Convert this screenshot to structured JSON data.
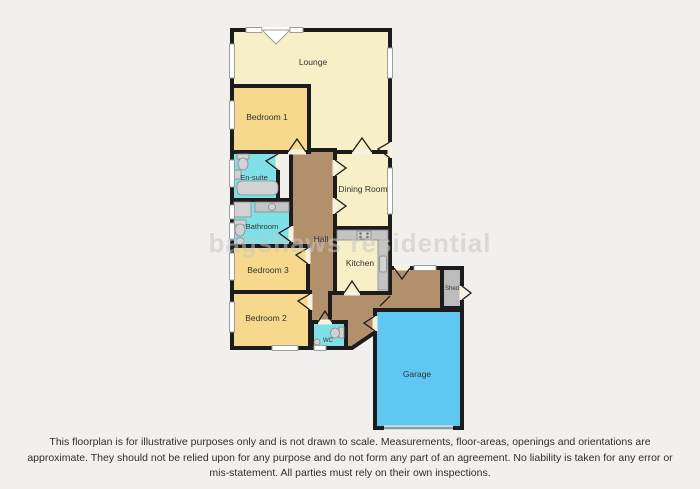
{
  "watermark": "bagshaws residential",
  "disclaimer": "This floorplan is for illustrative purposes only and is not drawn to scale. Measurements, floor-areas, openings and orientations are approximate. They should not be relied upon for any purpose and do not form any part of an agreement. No liability is taken for any error or mis-statement. All parties must rely on their own inspections.",
  "rooms": [
    {
      "label": "Lounge"
    },
    {
      "label": "Bedroom 1"
    },
    {
      "label": "En-suite"
    },
    {
      "label": "Bathroom"
    },
    {
      "label": "Dining Room"
    },
    {
      "label": "Hall"
    },
    {
      "label": "Kitchen"
    },
    {
      "label": "Bedroom 3"
    },
    {
      "label": "Bedroom 2"
    },
    {
      "label": "WC"
    },
    {
      "label": "Shed"
    },
    {
      "label": "Garage"
    }
  ],
  "colors": {
    "background": "#F1F0EE",
    "wall": "#1C1C1C",
    "living": "#F6EFC7",
    "bedroom": "#F6D98C",
    "wet": "#7FE0E8",
    "hall": "#B3906C",
    "garage": "#5FC8F2",
    "shed": "#BCBCBC",
    "window_frame": "#9E9E9E",
    "window_fill": "#FFFFFF",
    "door_gap": "#F7F2DE",
    "fixture_fill": "#D2D2D2",
    "fixture_stroke": "#8A8A8A",
    "counter": "#C4C4C4",
    "hob_dot": "#777777",
    "garage_door": "#7E9DB4",
    "label": "#333333",
    "watermark": "#C9C8C5"
  }
}
